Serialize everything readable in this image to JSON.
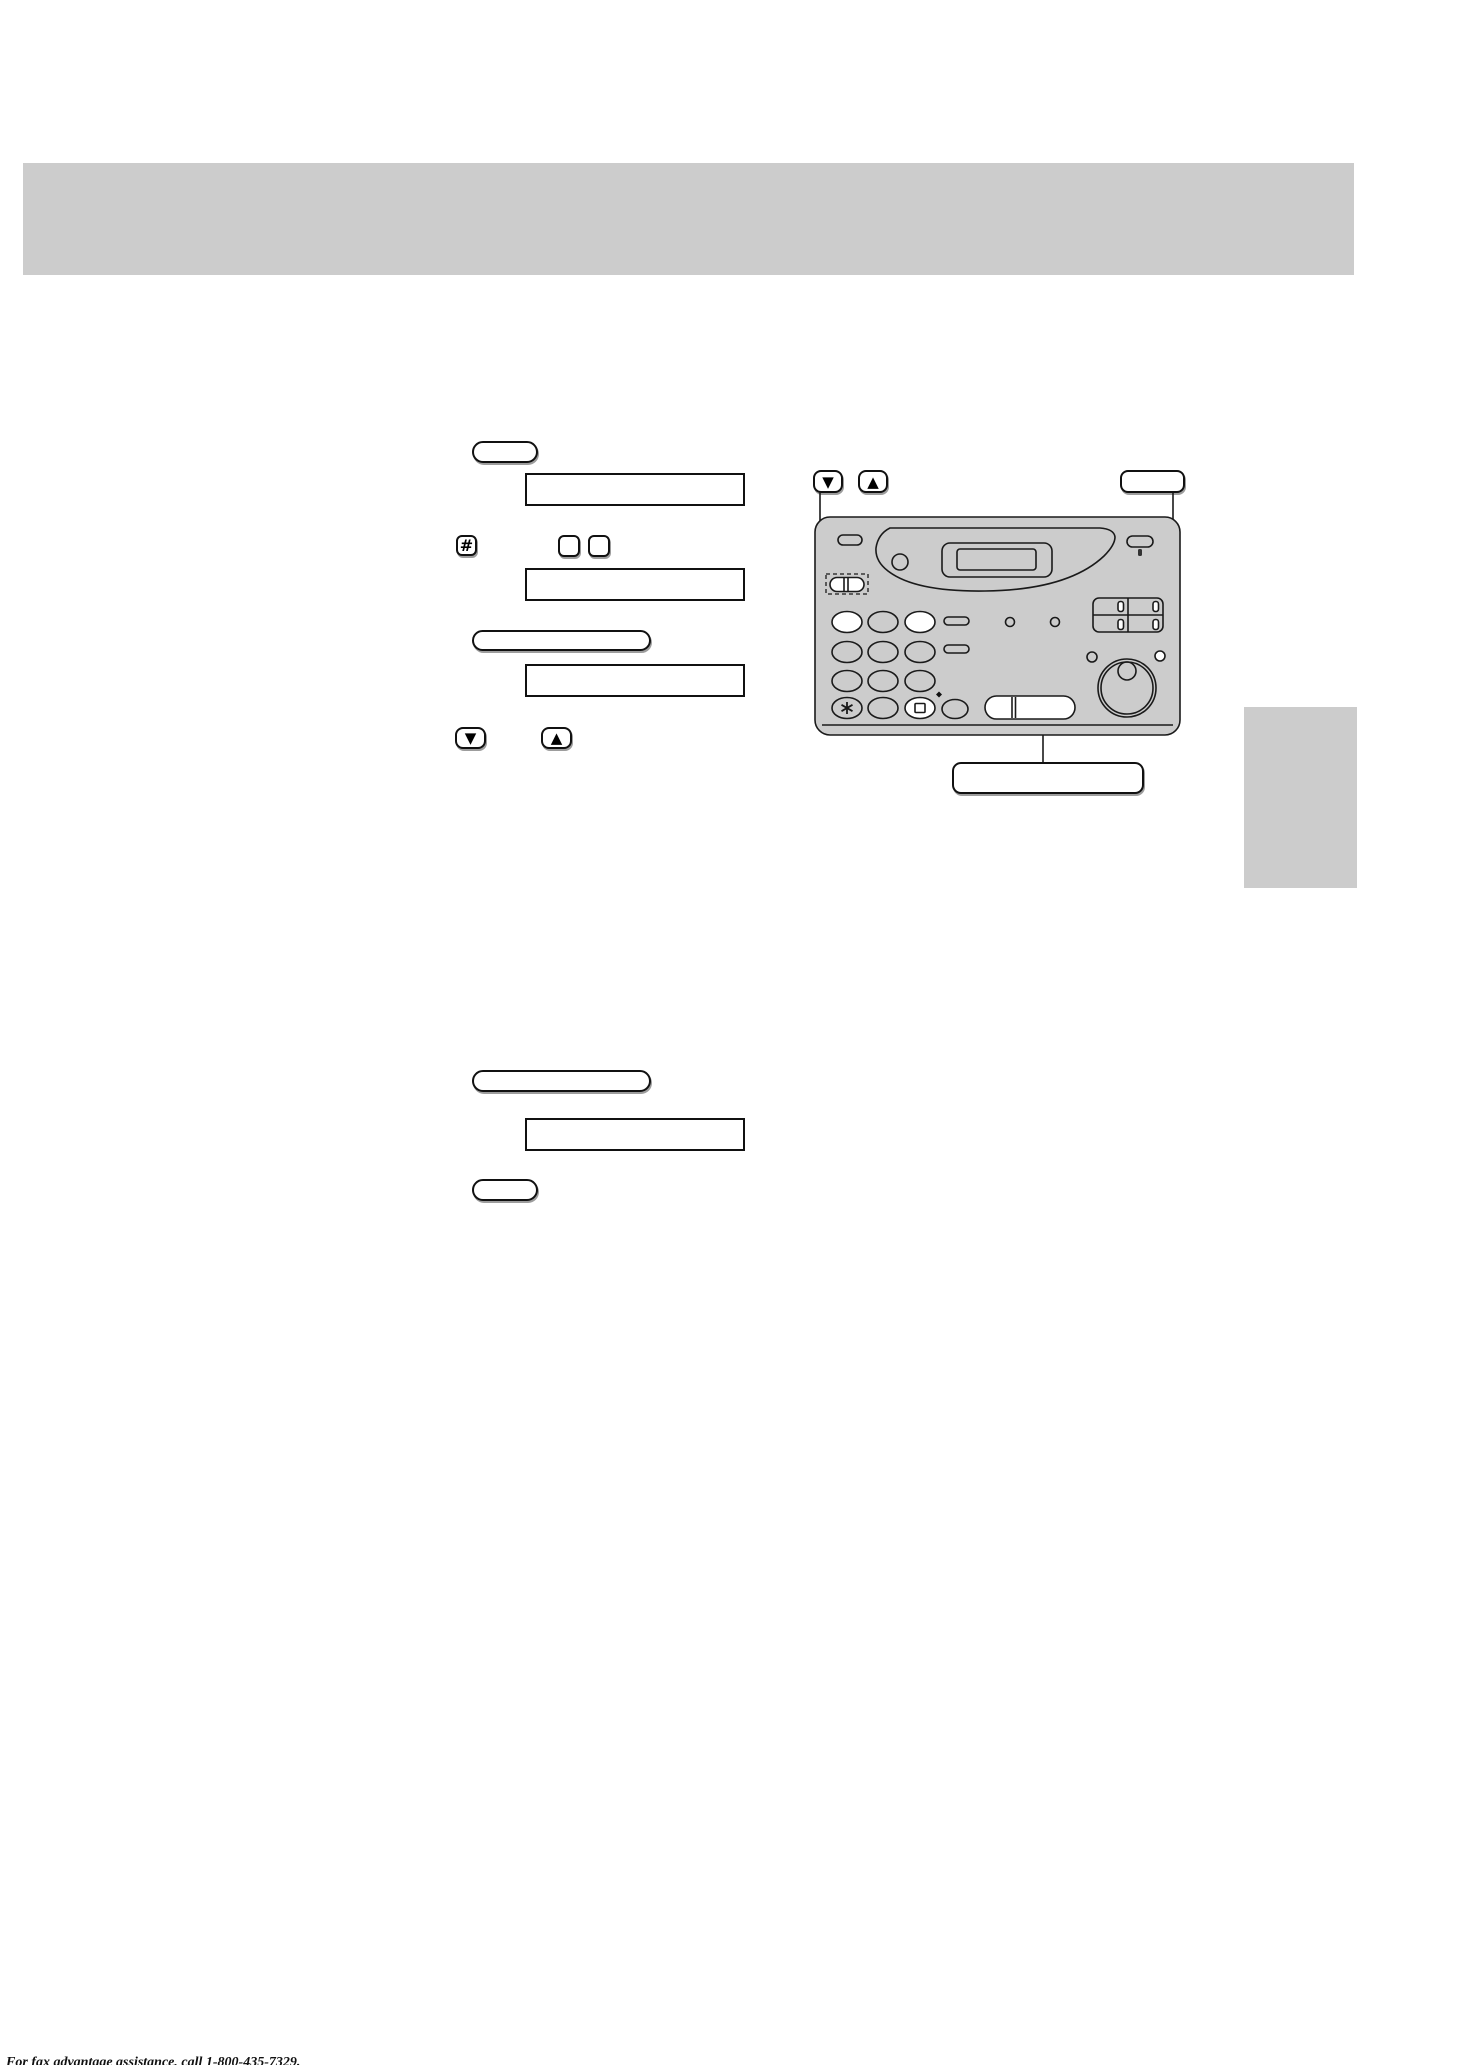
{
  "page": {
    "background": "#ffffff"
  },
  "top_banner": {
    "fill": "#cccccc",
    "text": ""
  },
  "side_tab": {
    "fill": "#cccccc",
    "text": ""
  },
  "palette": {
    "machine_body": "#cccccc",
    "outline": "#111111",
    "key_shadow": "#8c8c8c",
    "white_key": "#ffffff"
  },
  "icons": {
    "arrow_down": "▼",
    "arrow_up": "▲",
    "hash": "#",
    "star_key": "six-spoke-asterisk-shape",
    "square_key_glyph": "small-square-outline-shape",
    "navigator_key": "split-pill-with-dashed-outline"
  },
  "left_column": {
    "step1": {
      "menu_key_label": "",
      "display_box_1_text": ""
    },
    "step2": {
      "hash_key_label": "#",
      "code_key_1_label": "",
      "code_key_2_label": "",
      "display_box_2_text": ""
    },
    "step3": {
      "program_key_label": "",
      "display_box_3_text": ""
    },
    "step4": {
      "down_key_label": "▼",
      "up_key_label": "▲"
    }
  },
  "machine_callouts": {
    "down_key_label": "▼",
    "up_key_label": "▲",
    "top_right_button_label": "",
    "bottom_button_label": ""
  },
  "section2": {
    "program_key_label": "",
    "display_box_4_text": "",
    "small_key_label": ""
  },
  "footer": {
    "text": "For fax advantage assistance, call 1-800-435-7329."
  }
}
